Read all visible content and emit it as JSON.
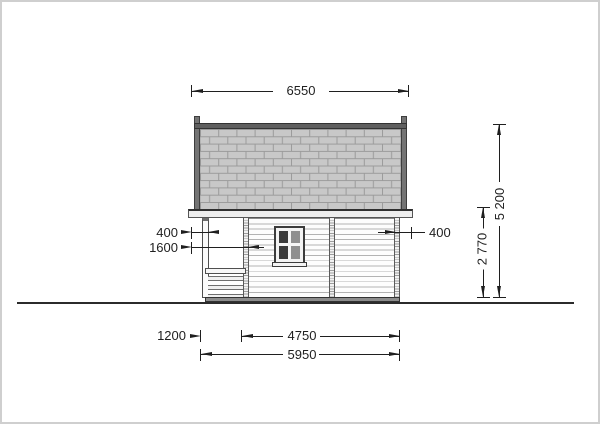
{
  "drawing": {
    "kind": "log-cabin side elevation, technical dimension drawing",
    "units": "mm",
    "colors": {
      "roof_shingle": "#c8c8c8",
      "roof_mortar": "#9b9b9b",
      "roof_ridge_band": "#5f5f5f",
      "fascia": "#ededed",
      "wall_log": "#fdfdfd",
      "wall_joint_line": "#b3b3b3",
      "window_glass_dark": "#3a3a3a",
      "window_glass_light": "#8f8f8f",
      "foundation": "#8c8c8c",
      "ground_line": "#2b2b2b",
      "dimension_ink": "#1f1f1f"
    }
  },
  "dims": {
    "roof_width": "6550",
    "eave_overhang_left": "400",
    "porch_inset": "1600",
    "eave_overhang_right": "400",
    "total_height": "5 200",
    "wall_height": "2 770",
    "porch_depth": "1200",
    "main_length": "4750",
    "total_length": "5950"
  }
}
